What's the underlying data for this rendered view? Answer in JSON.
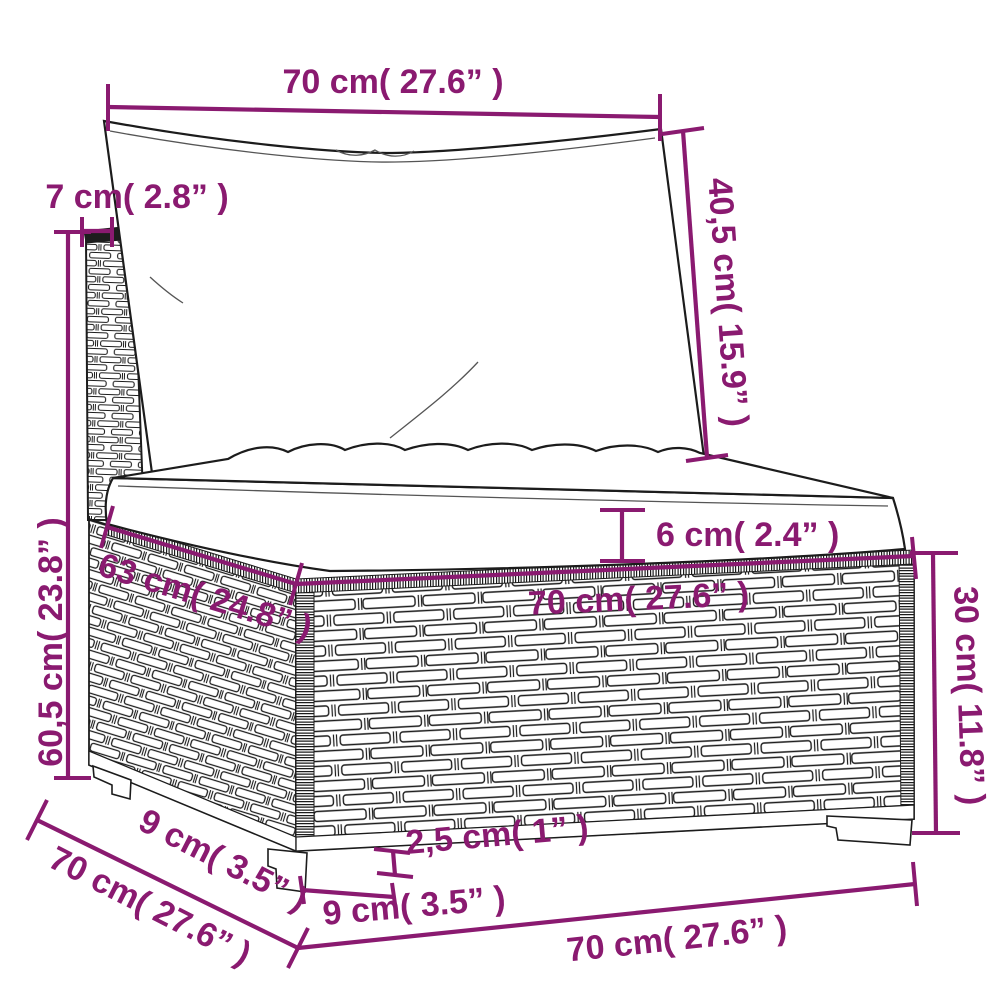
{
  "diagram": {
    "subject": "rattan middle sofa section with cushions - dimension drawing",
    "accent_color": "#8a1a70",
    "line_color": "#1c1c1c",
    "background": "#ffffff",
    "labels": {
      "back_width": "70 cm( 27.6” )",
      "back_height": "40,5 cm( 15.9” )",
      "back_thickness": "7 cm( 2.8” )",
      "total_height": "60,5 cm( 23.8” )",
      "seat_thickness": "6 cm( 2.4” )",
      "seat_depth": "63 cm( 24.8” )",
      "seat_width": "70 cm( 27.6” )",
      "base_height": "30 cm( 11.8” )",
      "foot_height": "2,5 cm( 1” )",
      "foot_width": "9 cm( 3.5” )",
      "foot_depth": "9 cm( 3.5” )",
      "total_depth": "70 cm( 27.6” )",
      "total_width": "70 cm( 27.6” )"
    }
  }
}
